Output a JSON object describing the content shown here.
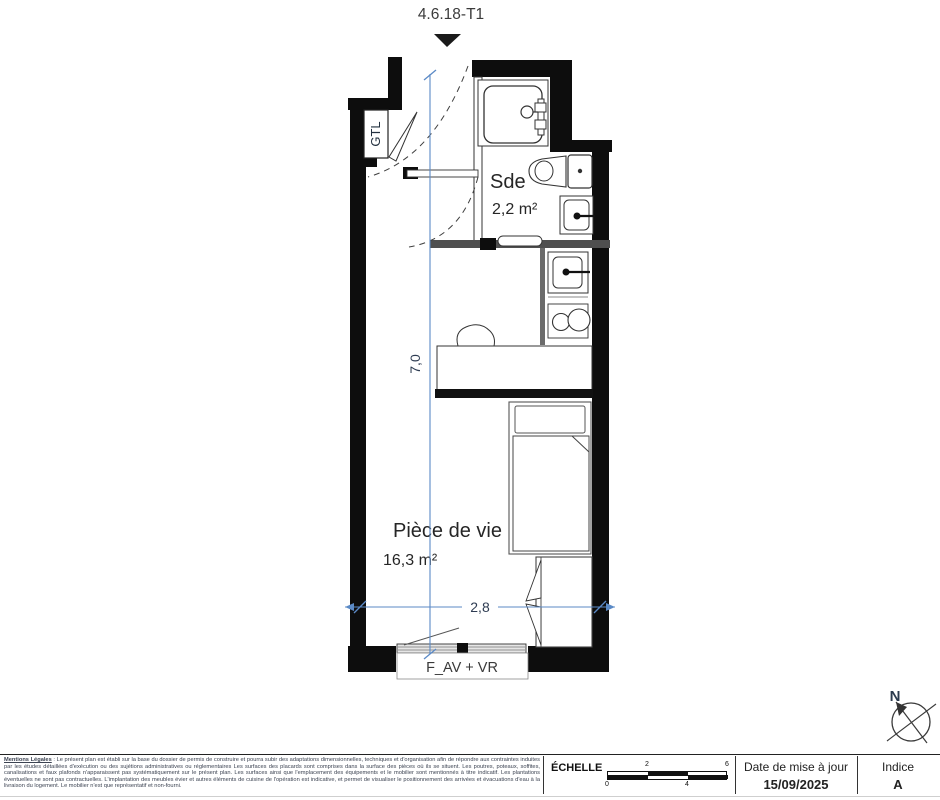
{
  "title": "4.6.18-T1",
  "plan": {
    "gtl_label": "GTL",
    "rooms": [
      {
        "name": "Sde",
        "area": "2,2 m²"
      },
      {
        "name": "Pièce de vie",
        "area": "16,3 m²"
      }
    ],
    "dimensions": {
      "height": "7,0",
      "width": "2,8"
    },
    "window_label": "F_AV + VR",
    "north_label": "N",
    "dimension_line_color": "#5b8ac6",
    "wall_color": "#0d0d0d"
  },
  "footer": {
    "legal_title": "Mentions Légales",
    "legal_text": " : Le présent plan est établi sur la base du dossier de permis de construire et pourra subir des adaptations dimensionnelles, techniques et d'organisation afin de répondre aux contraintes induites par les études détaillées d'exécution ou des sujétions administratives ou réglementaires Les surfaces des placards sont comprises dans la surface des pièces où ils se situent. Les poutres, poteaux, soffites, canalisations et faux plafonds n'apparaissent pas systématiquement sur le présent plan. Les surfaces ainsi que l'emplacement des équipements et le mobilier sont mentionnés à titre indicatif. Les plantations éventuelles ne sont pas contractuelles. L'implantation des meubles évier et autres éléments de cuisine de l'opération est indicative, et permet de visualiser le positionnement des arrivées et évacuations d'eau à la livraison du logement. Le mobilier n'est que représentatif et non-fourni.",
    "scale_label": "ÉCHELLE",
    "scale_ticks": [
      "0",
      "2",
      "4",
      "6"
    ],
    "date_label": "Date de mise à jour",
    "date_value": "15/09/2025",
    "indice_label": "Indice",
    "indice_value": "A"
  }
}
